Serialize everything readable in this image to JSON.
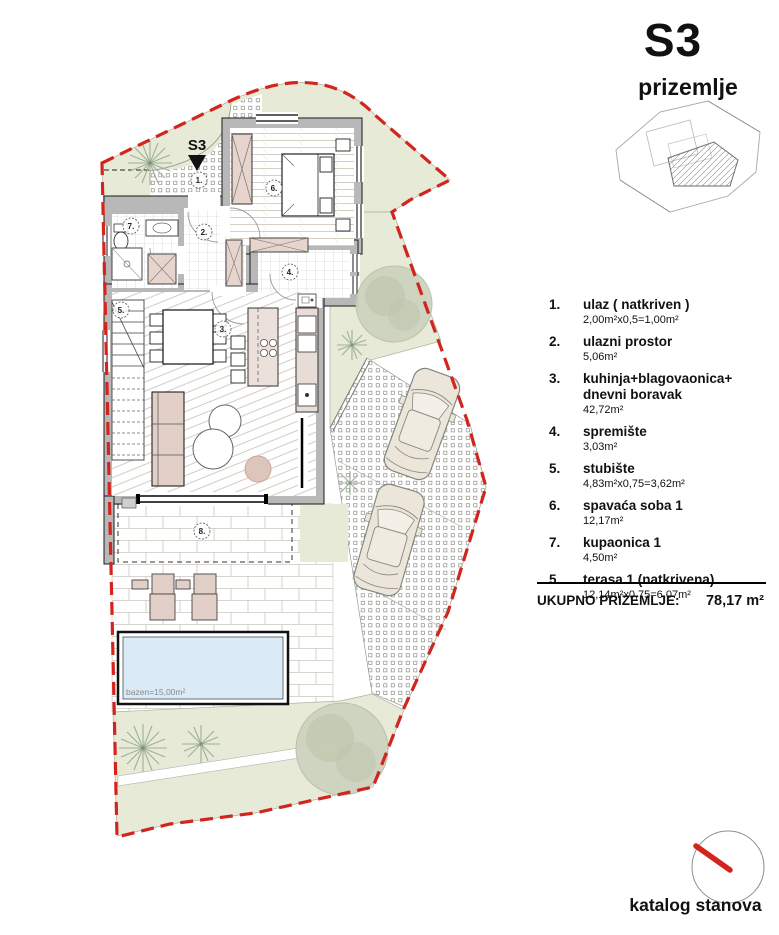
{
  "header": {
    "title": "S3",
    "subtitle": "prizemlje"
  },
  "legend": {
    "items": [
      {
        "num": "1.",
        "name": "ulaz ( natkriven )",
        "area": "2,00m²x0,5=1,00m²"
      },
      {
        "num": "2.",
        "name": "ulazni prostor",
        "area": "5,06m²"
      },
      {
        "num": "3.",
        "name": "kuhinja+blagovaonica+\ndnevni boravak",
        "area": "42,72m²"
      },
      {
        "num": "4.",
        "name": "spremište",
        "area": "3,03m²"
      },
      {
        "num": "5.",
        "name": "stubište",
        "area": "4,83m²x0,75=3,62m²"
      },
      {
        "num": "6.",
        "name": "spavaća soba 1",
        "area": "12,17m²"
      },
      {
        "num": "7.",
        "name": "kupaonica 1",
        "area": "4,50m²"
      },
      {
        "num": "5.",
        "name": "terasa 1 (natkrivena)",
        "area": "12,14m²x0,75=6,07m²"
      }
    ],
    "total_label": "UKUPNO PRIZEMLJE:",
    "total_value": "78,17 m²"
  },
  "plan": {
    "unit_marker": "S3",
    "pool_label": "bazen=15,00m²",
    "room_numbers": {
      "entry": "1.",
      "hall": "2.",
      "living": "3.",
      "storage": "4.",
      "stairs": "5.",
      "bedroom": "6.",
      "bath": "7.",
      "terrace": "8."
    }
  },
  "footer": {
    "label": "katalog stanova"
  },
  "colors": {
    "boundary": "#d2251d",
    "lawn": "#e6ead7",
    "pool": "#daeaf6",
    "wall": "#b8b8b8",
    "furniture": "#e7d5cd"
  }
}
